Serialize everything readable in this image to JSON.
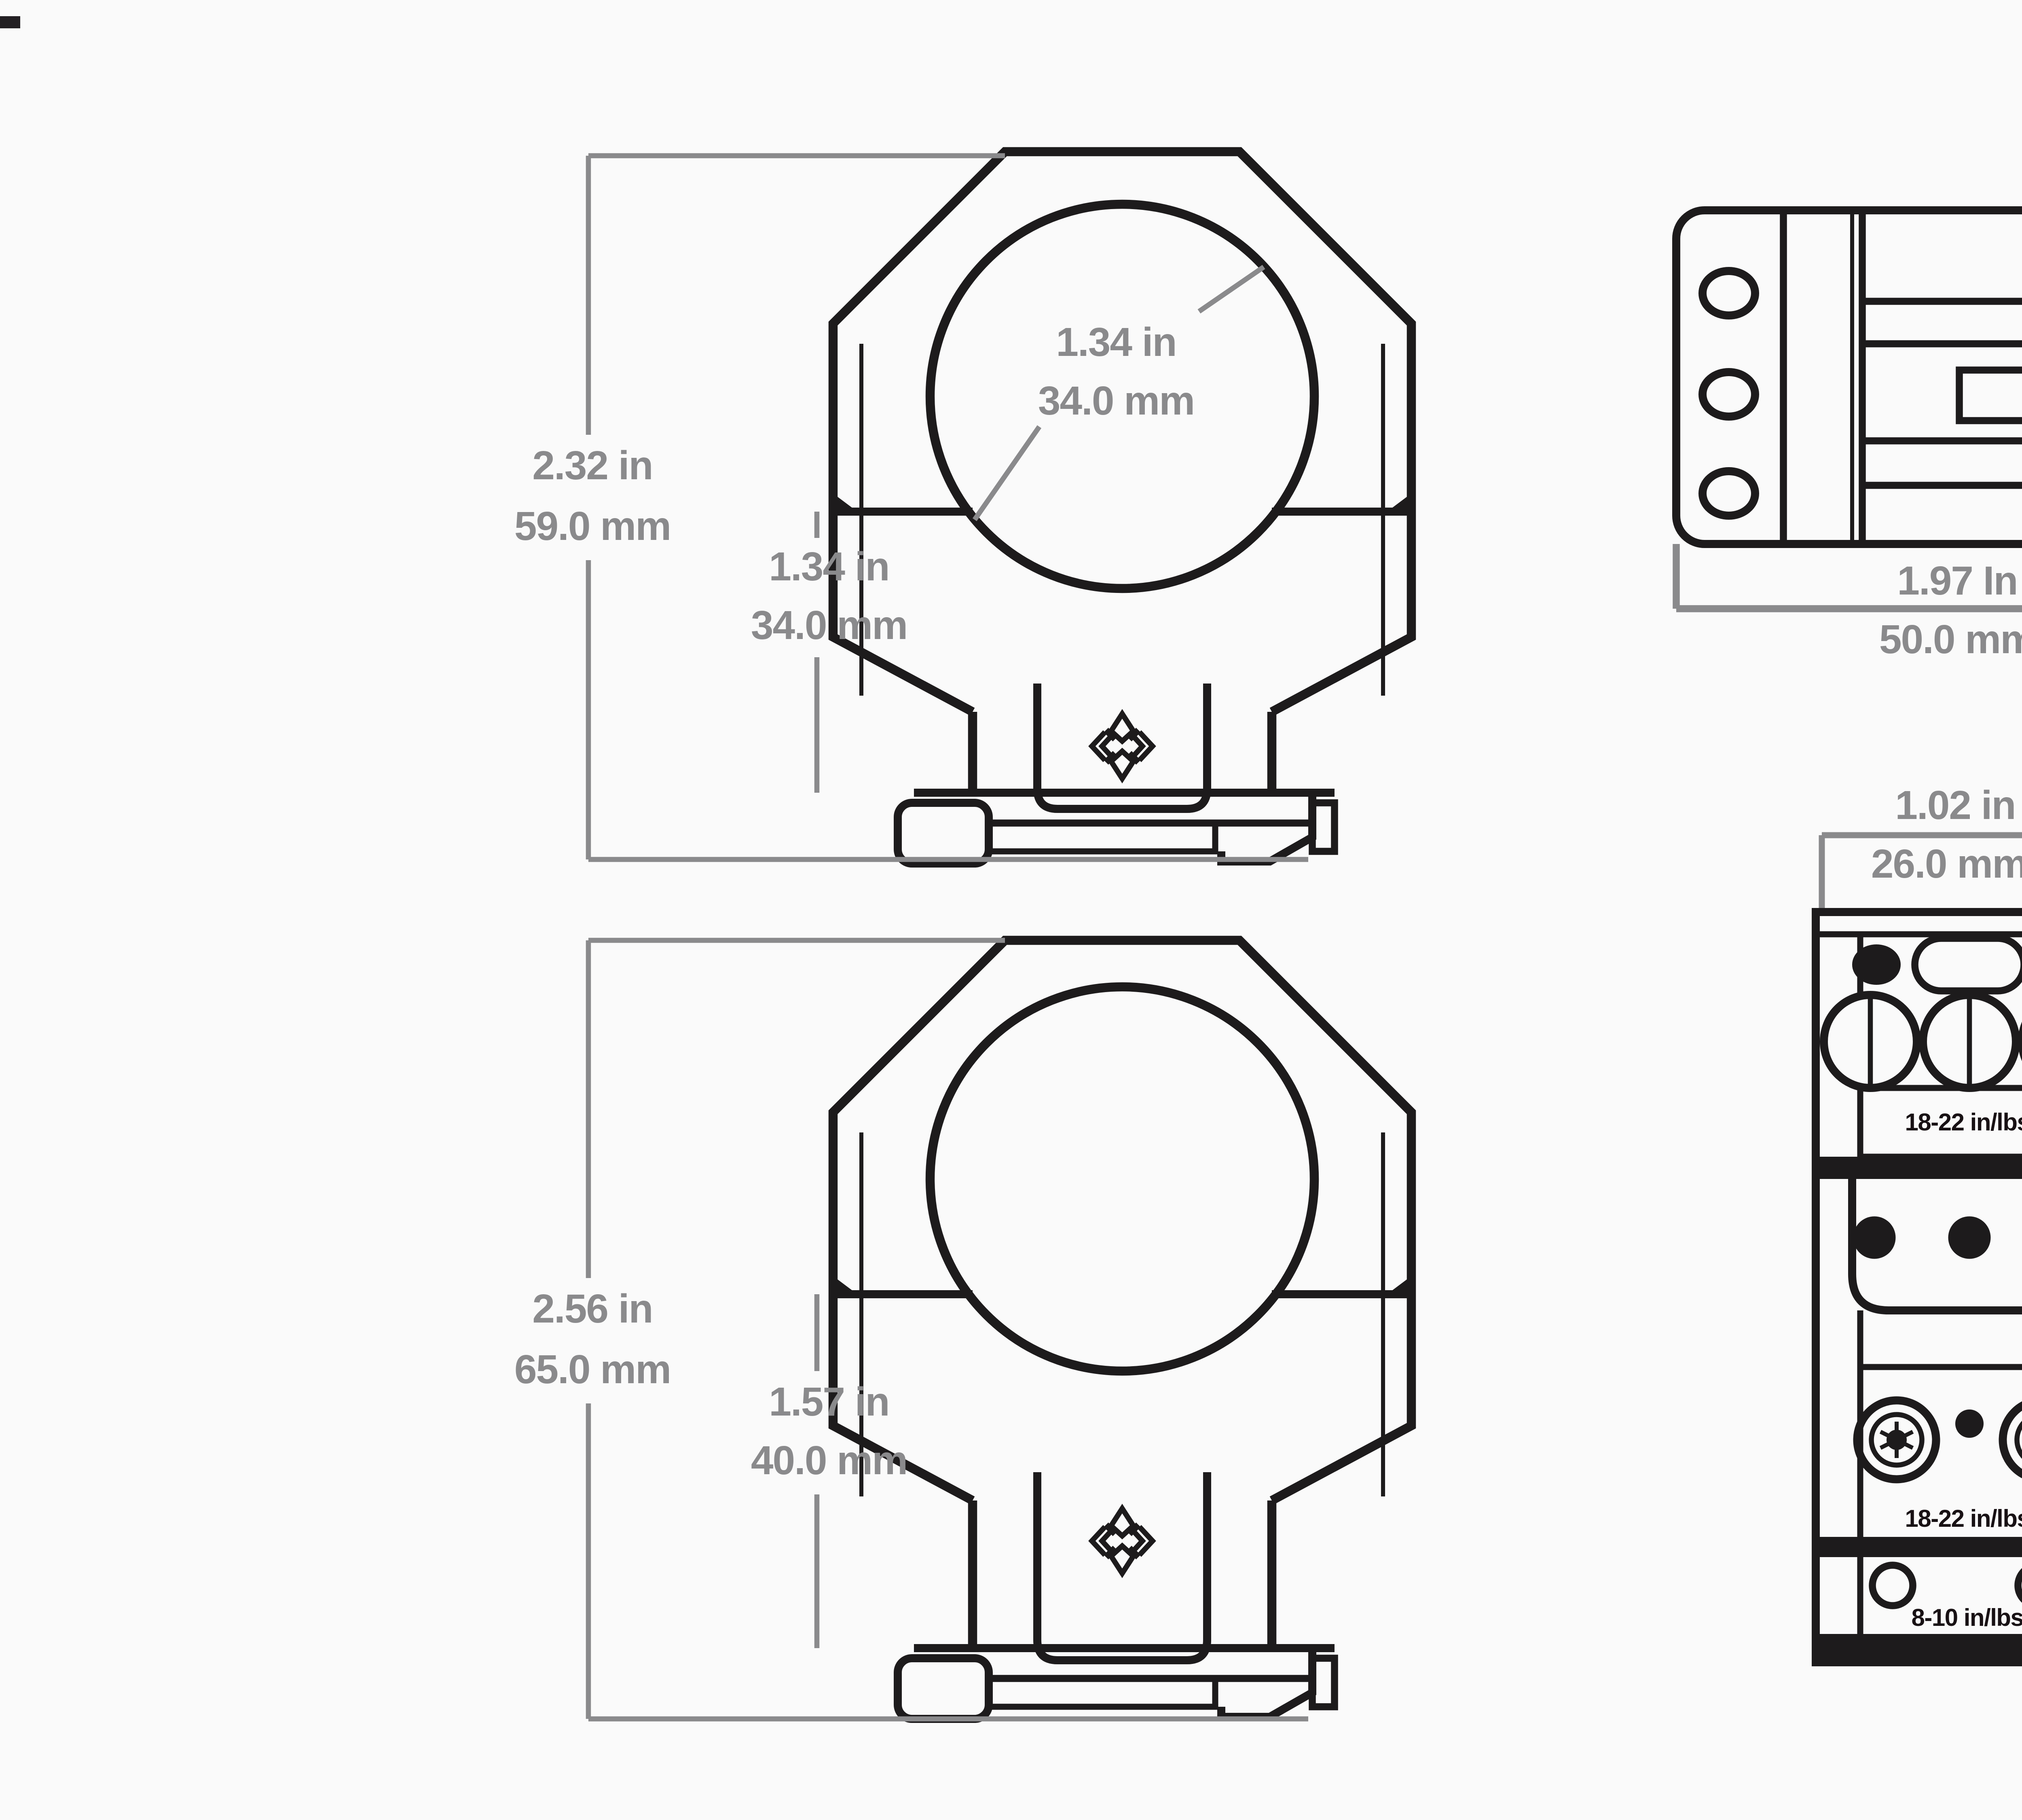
{
  "meta": {
    "description": "Technical dimension diagram of rifle scope rings and rail mount, four orthographic views",
    "colors": {
      "background": "#fafafa",
      "line": "#1d1b1c",
      "dim": "#8a8a8c",
      "text_dark": "#181114"
    }
  },
  "labels": {
    "ring1_bore_in": "1.34 in",
    "ring1_bore_mm": "34.0 mm",
    "ring1_height_in": "2.32 in",
    "ring1_height_mm": "59.0 mm",
    "ring1_saddle_in": "1.34 in",
    "ring1_saddle_mm": "34.0 mm",
    "ring2_height_in": "2.56 in",
    "ring2_height_mm": "65.0 mm",
    "ring2_saddle_in": "1.57 in",
    "ring2_saddle_mm": "40.0 mm",
    "topview_width_in": "1.97 In",
    "topview_width_mm": "50.0 mm",
    "sideview_width_in": "1.02 in",
    "sideview_width_mm": "26.0 mm",
    "torque_clamp": "18-22 in/lbs",
    "torque_mid": "18-22 in/lbs",
    "torque_small": "8-10 in/lbs"
  }
}
